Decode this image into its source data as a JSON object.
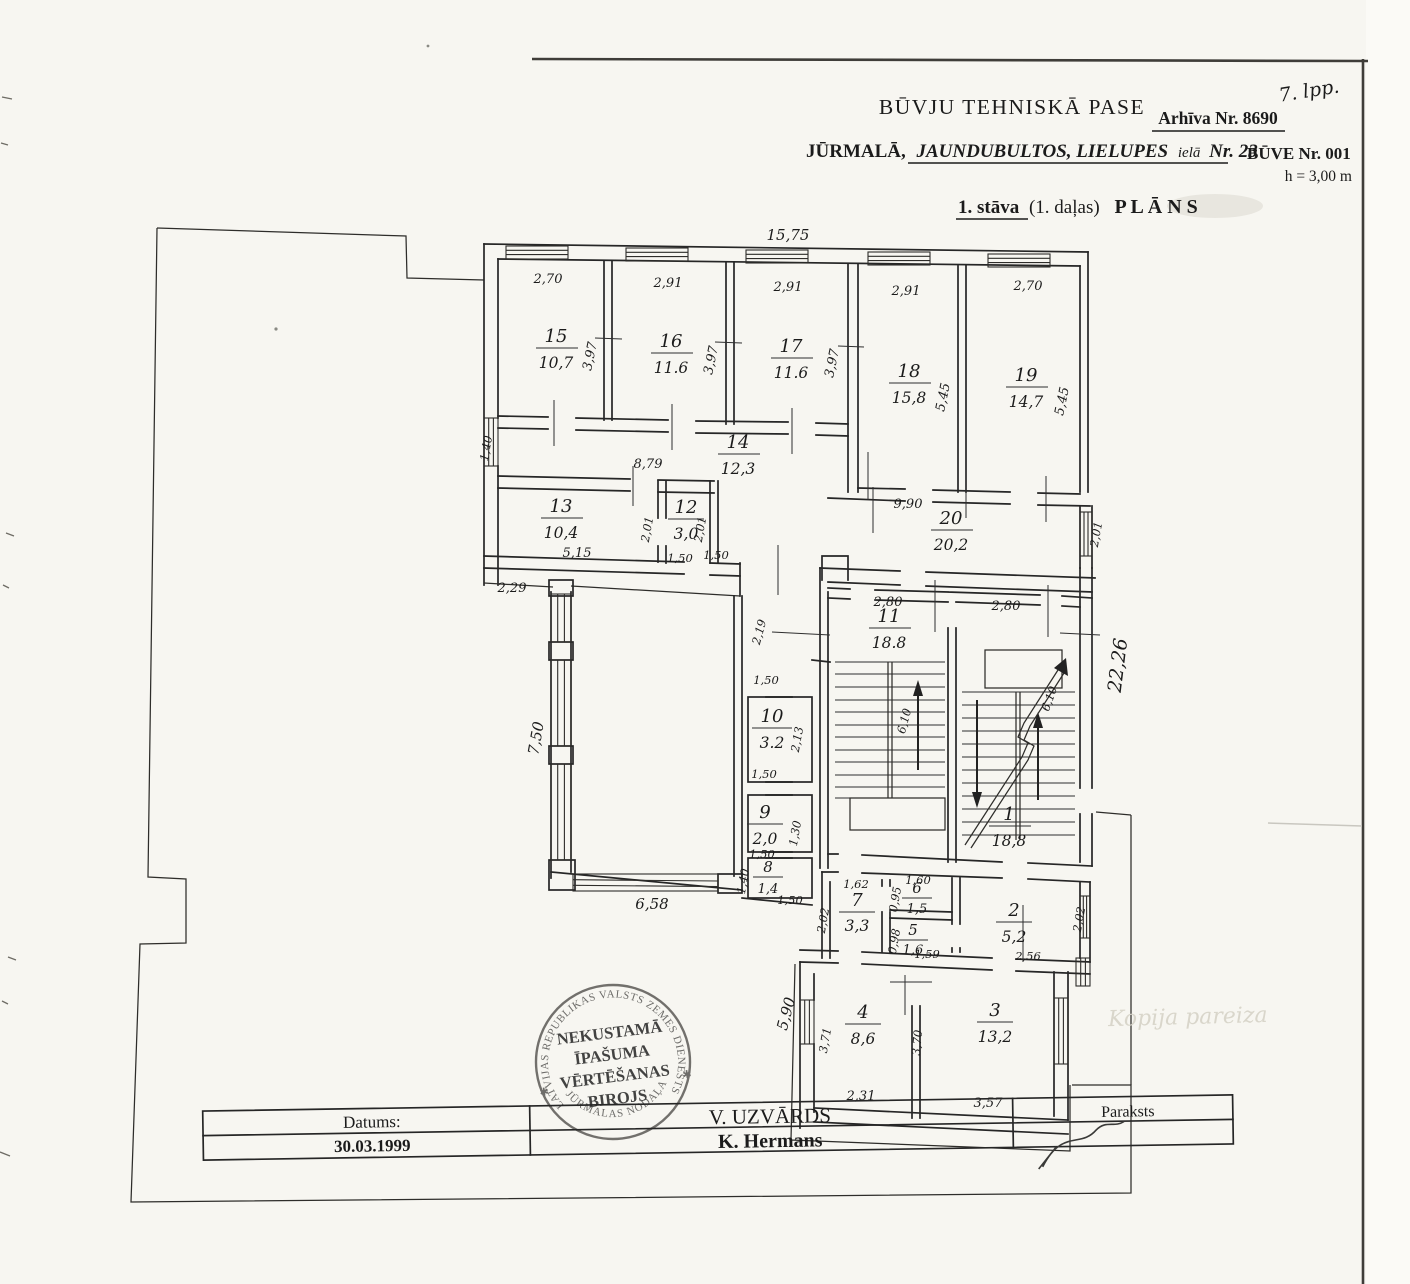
{
  "page": {
    "number_note": "7. lpp."
  },
  "header": {
    "title": "BŪVJU TEHNISKĀ PASE",
    "archive_label": "Arhīva Nr. 8690",
    "city": "JŪRMALĀ,",
    "address_street": "JAUNDUBULTOS, LIELUPES",
    "address_iela": "ielā",
    "address_nr": "Nr. 23",
    "building_label": "BŪVE Nr. 001",
    "height_note": "h = 3,00 m",
    "plan_floor": "1. stāva",
    "plan_part": "(1. daļas)",
    "plan_word": "P L Ā N S"
  },
  "plan": {
    "copy_note": "Kopija pareiza",
    "rooms": [
      {
        "number": "15",
        "area": "10,7"
      },
      {
        "number": "16",
        "area": "11.6"
      },
      {
        "number": "17",
        "area": "11.6"
      },
      {
        "number": "18",
        "area": "15,8"
      },
      {
        "number": "19",
        "area": "14,7"
      },
      {
        "number": "14",
        "area": "12,3"
      },
      {
        "number": "13",
        "area": "10,4"
      },
      {
        "number": "12",
        "area": "3,0"
      },
      {
        "number": "20",
        "area": "20,2"
      },
      {
        "number": "11",
        "area": "18.8"
      },
      {
        "number": "10",
        "area": "3.2"
      },
      {
        "number": "9",
        "area": "2,0"
      },
      {
        "number": "8",
        "area": "1,4"
      },
      {
        "number": "1",
        "area": "18,8"
      },
      {
        "number": "7",
        "area": "3,3"
      },
      {
        "number": "6",
        "area": "1,5"
      },
      {
        "number": "5",
        "area": "1,6"
      },
      {
        "number": "2",
        "area": "5,2"
      },
      {
        "number": "4",
        "area": "8,6"
      },
      {
        "number": "3",
        "area": "13,2"
      }
    ],
    "dims": {
      "t1575": "15,75",
      "w15": "2,70",
      "w16": "2,91",
      "w17": "2,91",
      "w18": "2,91",
      "w19": "2,70",
      "h15": "3,97",
      "h16": "3,97",
      "h17": "3,97",
      "h18": "5,45",
      "h19": "5,45",
      "c14": "8,79",
      "win14": "1,40",
      "b13": "5,15",
      "r13": "2,01",
      "b12": "1,50",
      "r12": "2,01",
      "t20": "9,90",
      "r20": "2,01",
      "right_total": "22,26",
      "c229": "2,29",
      "hall_h": "7,50",
      "hall_w": "6,58",
      "corr219": "2,19",
      "corr150": "1,50",
      "w11": "2,80",
      "s11": "6,10",
      "w1": "2,80",
      "s1": "6,10",
      "t10": "1,50",
      "r10": "2,13",
      "b10": "1,50",
      "r9": "1,30",
      "b9": "1,50",
      "l8": "1,40",
      "b8": "1,50",
      "w7": "1,62",
      "l7": "2,02",
      "w6": "1,60",
      "l6": "0,95",
      "l5": "0,98",
      "b5": "1,59",
      "r2": "2,02",
      "b2": "2,56",
      "l4": "3,71",
      "m4": "3,70",
      "b4": "2,31",
      "b3": "3,57",
      "l590": "5,90"
    }
  },
  "stamp": {
    "outer_top": "LATVIJAS REPUBLIKAS VALSTS ZEMES DIENESTS",
    "outer_bottom": "JŪRMALAS NODAĻA",
    "star_left": "✱",
    "star_right": "✱",
    "line1": "NEKUSTAMĀ",
    "line2": "ĪPAŠUMA",
    "line3": "VĒRTĒŠANAS",
    "line4": "BIROJS"
  },
  "signature_table": {
    "datums_label": "Datums:",
    "datums_value": "30.03.1999",
    "name_row1": "V. UZVĀRDS",
    "name_row2": "K. Hermans",
    "paraksts_label": "Paraksts"
  }
}
